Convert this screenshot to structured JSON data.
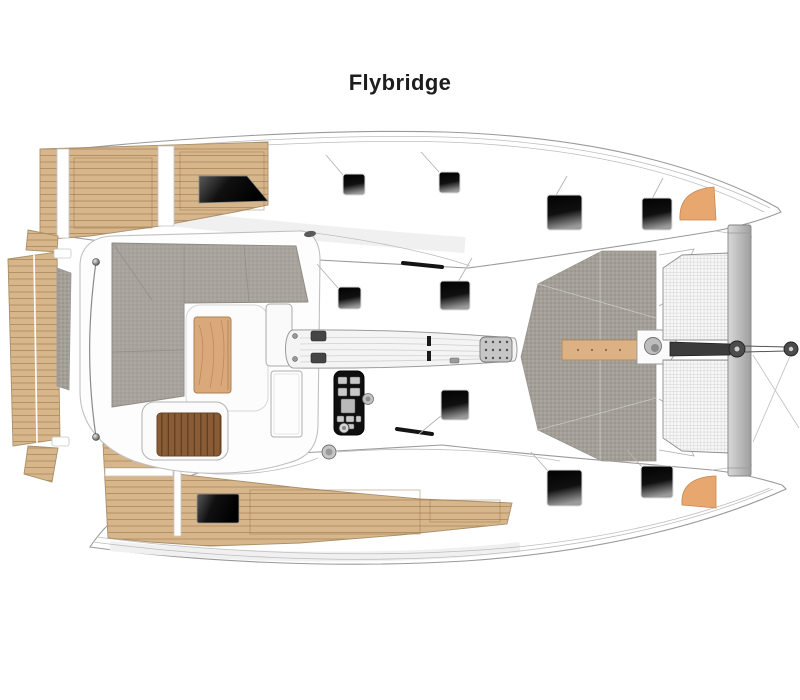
{
  "page": {
    "title": "Flybridge",
    "background": "#ffffff"
  },
  "palette": {
    "teak": "#d8b68c",
    "teak_line": "#b08c5e",
    "cushion": "#a8a49d",
    "deck_gray": "#a39f97",
    "hatch_black": "#0d0d0d",
    "wood_table": "#d9a97c",
    "wood_slats": "#8a5c36",
    "accent_orange": "#e8a76f",
    "outline": "#9a9a9a",
    "beam": "#bdbdbd",
    "bar_dark": "#3c3c3c"
  },
  "plan": {
    "features": [
      "port-hull",
      "starboard-hull",
      "swim-platform",
      "transom-steps",
      "aft-deck-port",
      "aft-deck-starboard",
      "flybridge-platform",
      "lounge-seating",
      "coffee-table",
      "sun-lounger",
      "helm-bench",
      "helm-console",
      "winch",
      "handrail",
      "mast-base",
      "boom",
      "foredeck",
      "trampoline",
      "forward-crossbeam",
      "bowsprit",
      "anchor-roller",
      "bow-fender",
      "deck-hatch",
      "companionway-opening"
    ],
    "hatches": [
      {
        "x": 343,
        "y": 174,
        "w": 22,
        "h": 21
      },
      {
        "x": 439,
        "y": 172,
        "w": 21,
        "h": 21
      },
      {
        "x": 547,
        "y": 195,
        "w": 35,
        "h": 35
      },
      {
        "x": 642,
        "y": 198,
        "w": 30,
        "h": 32
      },
      {
        "x": 338,
        "y": 287,
        "w": 23,
        "h": 22
      },
      {
        "x": 440,
        "y": 281,
        "w": 30,
        "h": 29
      },
      {
        "x": 441,
        "y": 390,
        "w": 28,
        "h": 30
      },
      {
        "x": 547,
        "y": 470,
        "w": 35,
        "h": 36
      },
      {
        "x": 641,
        "y": 466,
        "w": 32,
        "h": 32
      }
    ]
  }
}
